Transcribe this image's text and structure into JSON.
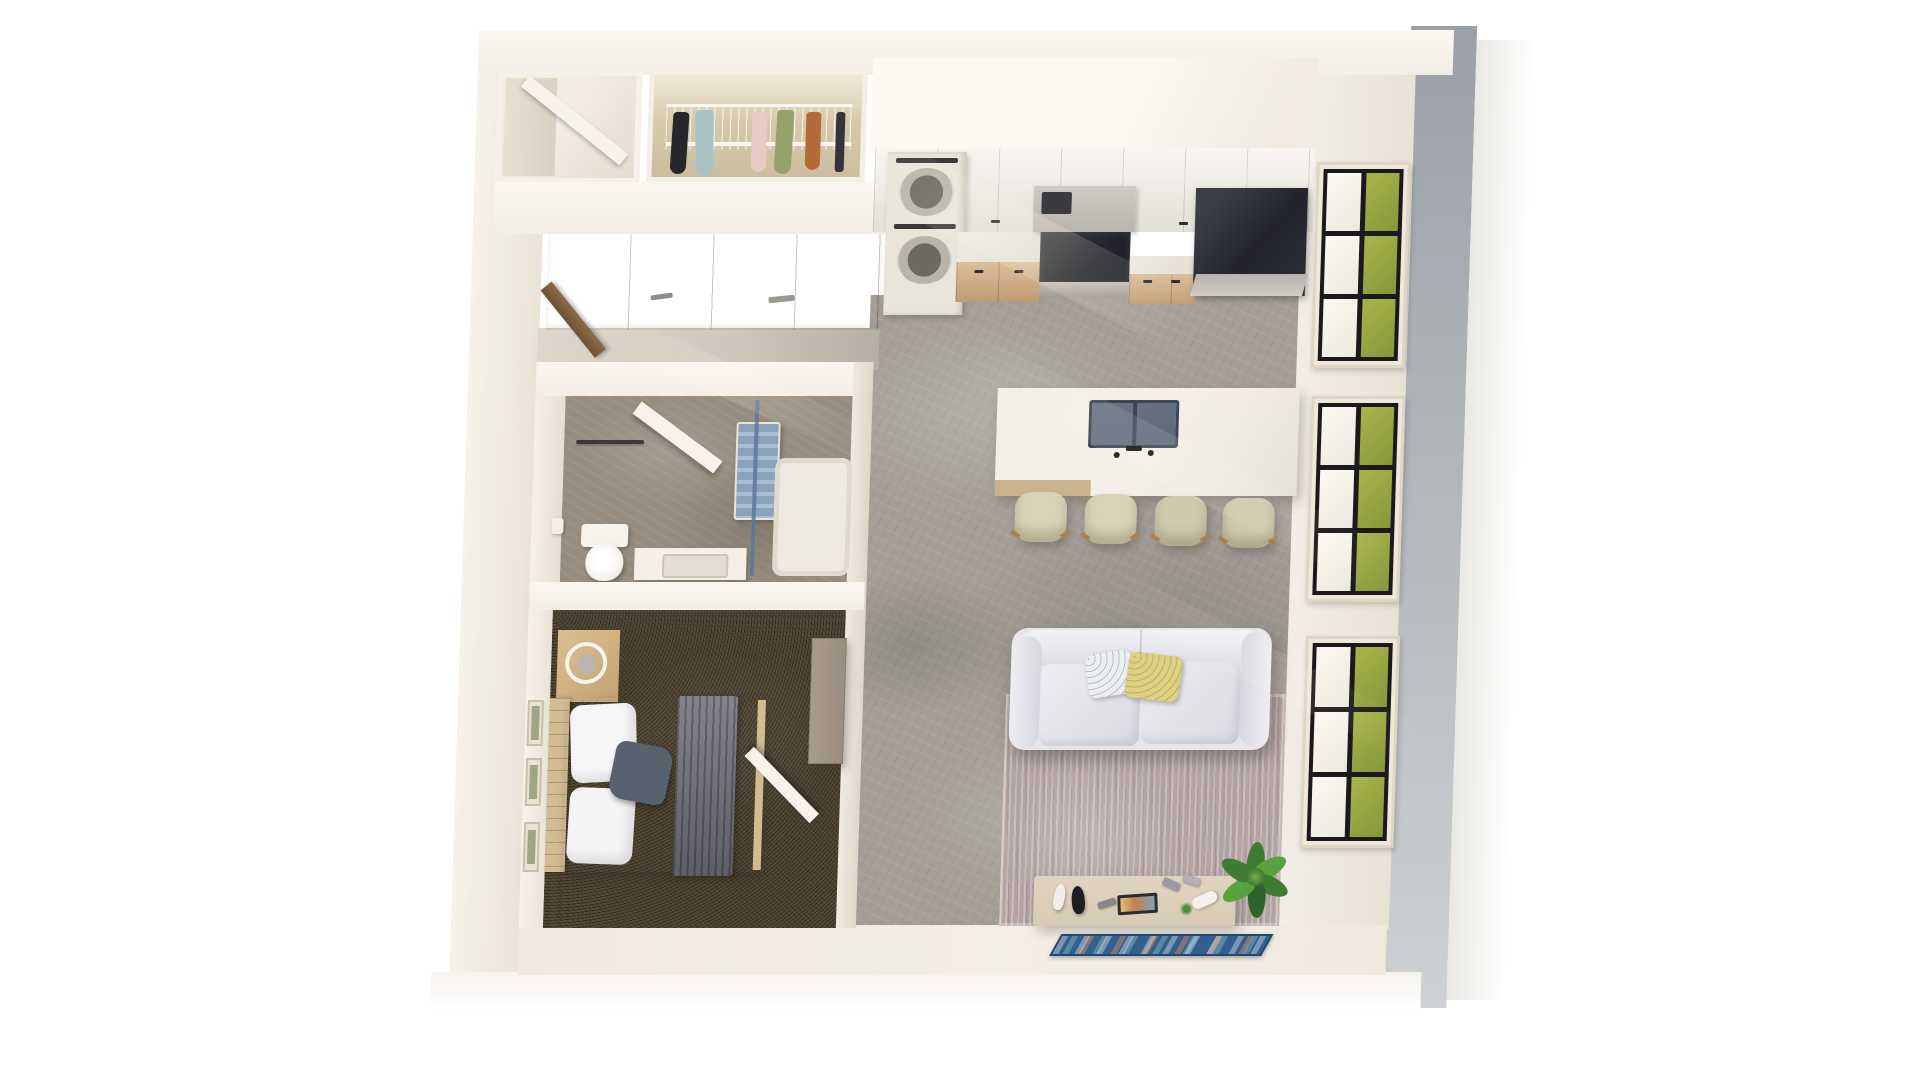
{
  "meta": {
    "description": "Top-down 3D dollhouse rendering of a one-bedroom apartment floor plan",
    "view": "birds-eye interior render, no text overlays"
  },
  "palette": {
    "wall_bright": "#faf7f1",
    "wall_sunlit": "#f2eee7",
    "wall_shadow": "#ddd6ca",
    "band_gray_dark": "#9aa0a6",
    "band_gray_light": "#ced1d3",
    "band_offwhite": "#eae8e3",
    "floor_concrete": "#a49e97",
    "floor_bath": "#978d7f",
    "floor_cream": "#efe9dd",
    "carpet_brown": "#4f4431",
    "cabinet_white": "#f1ede6",
    "cabinet_wood": "#cfa97a",
    "counter_white": "#ece7df",
    "appliance_black": "#23242b",
    "appliance_steel": "#b9b5af",
    "washer_white": "#e9e5da",
    "island_white": "#f0ece5",
    "island_wood": "#c9b48c",
    "sink_blue": "#5c6779",
    "stool_cream": "#d8d2b6",
    "stool_wood": "#a8834f",
    "window_frame": "#1a1a1e",
    "window_sill": "#efe8d9",
    "grass_green": "#86973c",
    "grass_light": "#a9b44a",
    "sofa_white": "#e6e6ea",
    "sofa_shadow": "#c9c9d3",
    "pillow_yellow": "#dcd083",
    "pillow_navy": "#59606e",
    "rug_mauve": "#b3a2a2",
    "rug_light": "#cfc4be",
    "console_wood": "#d8cbb5",
    "runner_blue": "#325f8d",
    "plant_green": "#3f7c33",
    "plant_light": "#57a23f",
    "closet_tan": "#d8c9ab",
    "door_white": "#f7f3ea",
    "door_wood": "#8a6a48",
    "towel_blue": "#8ba2bd",
    "bed_white": "#eaeaee",
    "throw_gray": "#6e6e78",
    "bed_wood": "#d3bc92",
    "dresser_wood": "#9a8d7d",
    "art_green": "#7d8f63"
  },
  "scene": {
    "rooms": [
      {
        "name": "Entry vestibule",
        "items": [
          "open entry door",
          "wood front door ajar"
        ]
      },
      {
        "name": "Walk-in closet",
        "items": [
          "wire shelving",
          "hanging garments"
        ]
      },
      {
        "name": "Hallway",
        "items": [
          "closet door bank with metal pulls"
        ]
      },
      {
        "name": "Kitchen",
        "items": [
          "white upper cabinets",
          "range hood",
          "black range",
          "stacked washer dryer",
          "wood base cabinets",
          "black refrigerator",
          "quartz island with double sink and faucet",
          "bar stools"
        ]
      },
      {
        "name": "Bathroom",
        "items": [
          "open door",
          "towel bar",
          "toilet",
          "toilet paper holder",
          "vanity sink",
          "glass shower screen",
          "shower pan"
        ]
      },
      {
        "name": "Bedroom",
        "items": [
          "slat headboard bed",
          "white duvet",
          "gray throw blanket",
          "accent pillow",
          "nightstand with ring lamp",
          "tall dresser",
          "botanical wall art",
          "open door"
        ]
      },
      {
        "name": "Living room",
        "items": [
          "white sofa",
          "patterned pillow",
          "yellow pillow",
          "distressed mauve area rug",
          "media console with decor",
          "potted plant",
          "blue patterned runner rug"
        ]
      },
      {
        "name": "Exterior",
        "items": [
          "three black-grid windows",
          "green lawn outside",
          "gray facade band"
        ]
      }
    ],
    "garment_colors": [
      "#26262b",
      "#a9c2c6",
      "#e8c9c4",
      "#97a26b",
      "#b56b39",
      "#33333a"
    ]
  },
  "counts": {
    "windows": 3,
    "bar_stools": 4,
    "closet_garments": 6,
    "wall_art_frames": 3,
    "sofa_pillows": 2,
    "seat_cushions": 2
  }
}
